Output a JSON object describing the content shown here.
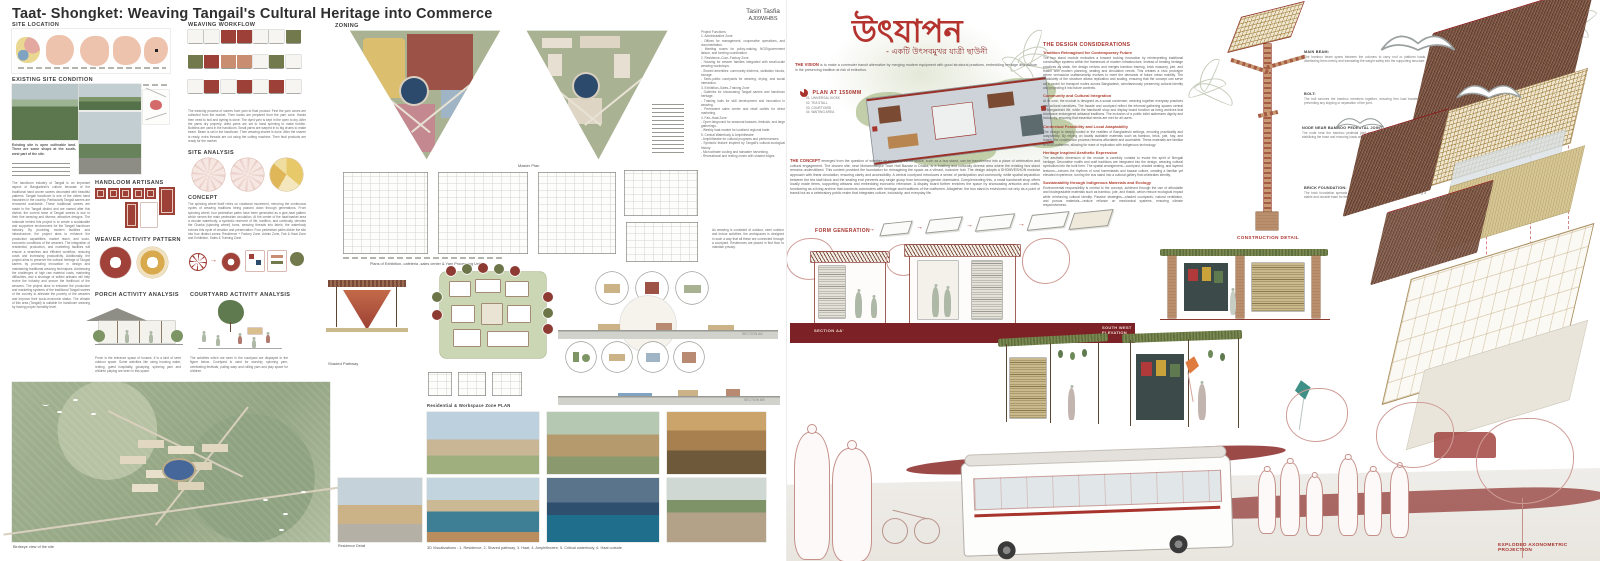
{
  "colors": {
    "accent_red": "#a8342e",
    "title_red": "#b4332e",
    "maroon_band": "#7c2125",
    "olive": "#77814f",
    "sage_map": "#a9b292",
    "pond_navy": "#2c4a6b",
    "thatch_brown": "#6e4a3d",
    "bamboo_tan": "#b99f6f"
  },
  "left_board": {
    "title": "Taat- Shongket: Weaving Tangail's Cultural Heritage into Commerce",
    "author_name": "Tasin Tasfia",
    "author_id": "AJ09WHBS",
    "headings": {
      "site_location": "SITE LOCATION",
      "existing_site": "EXISTING SITE CONDITION",
      "handloom_artisans": "HANDLOOM ARTISANS",
      "weaver_activity": "WEAVER ACTIVITY PATTERN",
      "porch_activity": "PORCH ACTIVITY ANALYSIS",
      "courtyard_activity": "COURTYARD ACTIVITY ANALYSIS",
      "weaving_workflow": "WEAVING WORKFLOW",
      "site_analysis": "SITE ANALYSIS",
      "concept": "CONCEPT",
      "zoning": "ZONING"
    },
    "texts": {
      "existing_site_note": "Existing site is open cultivable land. There are some shops at the south-west part of the site.",
      "intro": "The handloom industry of Tangail is an important aspect of Bangladesh's culture because of the traditional hand woven sarees decorated with beautiful patterns. Tangail handloom is one of the oldest hand industries in the country. Particularly Tangail sarees are renowned worldwide. These traditional sarees are made in the Tangail district and are named after this district; the current fame of Tangail sarees is due to their fine weaving and diverse, attractive designs. The rationale behind this project is to create a sustainable and supportive environment for the Tangail handloom industry. By providing modern facilities and infrastructure, the project aims to enhance the production capabilities, market reach, and socio-economic conditions of the weavers. The integration of residential, production, and marketing facilities will ensure a seamless and efficient workflow, reducing costs and increasing productivity. Additionally, the project aims to preserve the cultural heritage of Tangail sarees by promoting innovation in design and maintaining traditional weaving techniques. Addressing the challenges of high raw material costs, marketing difficulties, and a shortage of skilled artisans will help revive the industry and secure the livelihood of the weavers. The project aims to enhance the production and marketing systems of the traditional Tangail sarees of the country to alleviate the poverty of the weavers and improve their socio-economic status. The climate of this area (Tangail) is suitable for handloom weaving by having proper humidity level.",
      "weaving_workflow_caption": "The weaving process of sarees from yarn to final product: First the yarn cones are collected from the market. Then hanks are prepared from the yarn cone. Hanks then need to boil and dyeing is done. The dyed yarn is kept in the open to dry. After the yarns dry properly, dried yarns are set to hand spinning to make bobbin. Bobbins are used in the handloom. Small yarns are warped in to big drums to make beam. Beam is set in the handloom. Then weaving sharee is done. After the sharee is ready, extra threads are cut using the cutting machine. Then final products are ready for the market.",
      "porch_caption": "Porch is the entrance space of houses. It is a kind of semi outdoor space. Some activities like using housing water, resting, guest hospitality, gossiping, spinning yarn and children playing are seen in this space.",
      "courtyard_caption": "The activities which are seen in the courtyard are displayed in the figure below. Courtyard is used for worship, spinning yarn, celebrating festivals, pulling warp and rolling yarn and play space for children.",
      "concept_text": "The spinning wheel itself relies on rotational movement, mirroring the continuous cycles of weaving traditions being passed down through generations. From spinning wheel, four pedestrian paths have been generated as a give-haat pattern which serves the main pedestrian circulation. At the center of the haat/market area a circular waterbody, a symbolic reservoir of life, tradition, and continuity, denotes the Charka (spinning wheel) turns, weaving threads into fabric; the waterbody echoes this cycle of creation and preservation. Four pedestrian paths divide the site into four distinct zones: Residence + Factory Zone, Admin Zone, Fair & Haat Zone and Exhibition, Sales & Training Zone.",
      "residence_note": "As weaving is consisted of outdoor, semi outdoor and indoor activities, the workspaces is designed in such a way that all these are connected through a courtyard. Residences are placed in first floor to maintain privacy.",
      "project_functions": "Project Functions:\n1. Administrative Zone\n- Offices for management, cooperative operations, and documentation.\n- Meeting rooms for policy-making, NGO/government liaison, and funding coordination.\n2. Residence–Cum–Factory Zone\n- Housing for weaver families integrated with small-scale weaving workshops.\n- Shared amenities: community kitchens, sanitation blocks, storage.\n- Semi-public courtyards for weaving, drying, and social interaction.\n3. Exhibition–Sales–Training Zone\n- Galleries for showcasing Tangail sarees and handloom heritage.\n- Training halls for skill development and innovation in weaving.\n- Permanent sales center and retail outlets for direct marketing.\n4. Fair–Haat Zone\n- Open fairground for seasonal bazaars, festivals, and large gatherings.\n- Weekly haat market for localized regional trade.\n5. Central Waterbody & Amphitheatre\n- Amphitheatre for cultural programs and performances.\n- Symbolic feature inspired by Tangail's cultural-ecological history.\n- Microclimate cooling and rainwater harvesting.\n- Recreational and resting zones with shaded edges."
    },
    "captions": {
      "master_plan": "Master Plan",
      "master_plan_inmap": "MASTER PLAN",
      "plans_row": "Plans of Exhibition- cafeteria -sales center & Yarn Processing Unit",
      "shaded_pathway": "Shaded Pathway",
      "residential_plan": "Residential & Workspace Zone PLAN",
      "section_aa": "SECTION AA'",
      "section_bb": "SECTION BB'",
      "birdseye": "Birdseye view of the site",
      "residence_detail": "Residence Detail",
      "visualizations": "3D Visualizations : 1. Residence, 2. Shared pathway, 3. Haat, 4. Amphitheatre, 5. Critical waterbody, 6. Haat outside"
    }
  },
  "right_board": {
    "title_bengali": "উৎযাপন",
    "subtitle_bengali": "- একটি উৎসবমুখর যাত্রী ছাউনী",
    "vision_label": "THE VISION",
    "vision_text": "is to make a commuter transit alternative by merging modern equipment with good structural practices, embedding heritage and culture in the preserving tradition at risk of extinction.",
    "plan_label": "PLAN AT 1550MM",
    "legend_col1": "01. UNIVERSAL KIOSK\n02. TEA STALL\n03. COURTYARD\n04. WAITING AREA",
    "legend_col2": "05. LIVING ARCHIVE\n06. HANDICRAFT SHOP\n07. WASHROOM",
    "concept_label": "THE CONCEPT",
    "concept_text": "emerged from the question of whether an everyday transit space, such as a bus stand, can be transformed into a place of celebration and cultural engagement. The chosen site, near Mohammadpur Town Hall Bazaar in Dhaka, is a bustling and culturally diverse area where the existing bus stand remains underutilized. This context provided the foundation for reimagining the space as a vibrant, inclusive hub. The design adopts a SHOMVESHON modular approach with linear circulation, ensuring clarity and accessibility. A central courtyard introduces a sense of participation and community, while spatial separation between the tea stall block and the seating end prevents any single group from becoming gender dominated. Complementing this, a small handicraft shop offers locally made items, supporting artisans and embedding economic relevance. A display board further enriches the space by showcasing artworks and crafts, functioning as a living archive that connects commuters with heritage and traditions of the craftsmen. Altogether, the bus stand is envisioned not only as a point of transit but as a celebratory public realm that integrates culture, inclusivity, and everyday life.",
    "design_considerations": {
      "heading": "THE DESIGN CONSIDERATIONS",
      "items": [
        {
          "title": "Tradition Reimagined for Contemporary Future",
          "body": "The bus stand module embodies a forward looking innovation by reinterpreting traditional construction systems within the framework of modern infrastructure. Instead of treating heritage practices as static, the design revives and merges bamboo framing, brick masonry, jute, and thatch with modern planning, seating and circulation needs. This creates a civic prototype where vernacular craftsmanship evolves to meet the demands of future urban mobility. The modularity of the structure allows replication and scaling, ensuring that the concept can serve as a model for transport nodes across Bangladesh, simultaneously preserving cultural identity and projecting it into future contexts."
        },
        {
          "title": "Community and Cultural Integration",
          "body": "At its core, the module is designed as a social condenser, weaving together everyday practices and cultural narratives. The facade and courtyard reflect the informal gathering spaces central to Bangladeshi life, while the handicraft shop and display board function as living archives that showcase endangered artisanal traditions. The inclusion of a public toilet addresses dignity and inclusivity, ensuring that essential needs are met for all users."
        },
        {
          "title": "Contextual Feasibility and Local Adaptability",
          "body": "The design is deeply rooted in the realities of Bangladeshi settings, ensuring practicality and adaptability. By relying on locally available materials such as bamboo, brick, jute, hay, and thatch, the construction process remains affordable and accessible. These materials are familiar to local craftsmen, allowing for ease of replication with indigenous technology."
        },
        {
          "title": "Heritage Inspired Aesthetic Expression",
          "body": "The aesthetic dimension of the module is carefully curated to evoke the spirit of Bengali heritage. Decorative motifs and craft traditions are integrated into the design, weaving cultural symbolism into the built form. The spatial arrangement—courtyard, shaded seating, and layered textures—echoes the rhythms of rural homesteads and bazaar culture, creating a familiar yet elevated experience, turning the bus stand into a cultural gallery that celebrates identity."
        },
        {
          "title": "Sustainability through Indigenous Materials and Ecology",
          "body": "Environmental responsibility is central to the concept, achieved through the use of affordable and biodegradable materials such as bamboo, jute, and thatch, which reduce ecological impact while reinforcing cultural identity. Passive strategies—shaded courtyards, natural ventilation, and porous materials—reduce reliance on mechanical systems, ensuring climate responsiveness."
        }
      ]
    },
    "labels": {
      "form_generation": "FORM GENERATION",
      "section_aa": "SECTION AA'",
      "south_west_elevation": "SOUTH WEST ELEVATION",
      "construction_detail": "CONSTRUCTION DETAIL",
      "exploded_axonometric": "EXPLODED AXONOMETRIC PROJECTION"
    },
    "callouts": [
      {
        "title": "MAIN BEAM:",
        "body": "The bamboo beam spans between the columns to carry roof or platform loads, distributing them evenly and translating the weight safely into the supporting structure."
      },
      {
        "title": "BOLT:",
        "body": "The bolt secures the bamboo members together, ensuring firm load transfer and preventing any slipping or separation of the joint."
      },
      {
        "title": "NODE NEAR BAMBOO PEDESTAL JOINT:",
        "body": "The node near the bamboo pedestal joint anchors the column to the foundation, stabilizing the base and ensuring loads are safely transferred into the ground."
      },
      {
        "title": "BRICK FOUNDATION:",
        "body": "The brick foundation spreads the structural loads evenly into the soil, providing a stable and durable base for the bamboo columns."
      }
    ]
  }
}
